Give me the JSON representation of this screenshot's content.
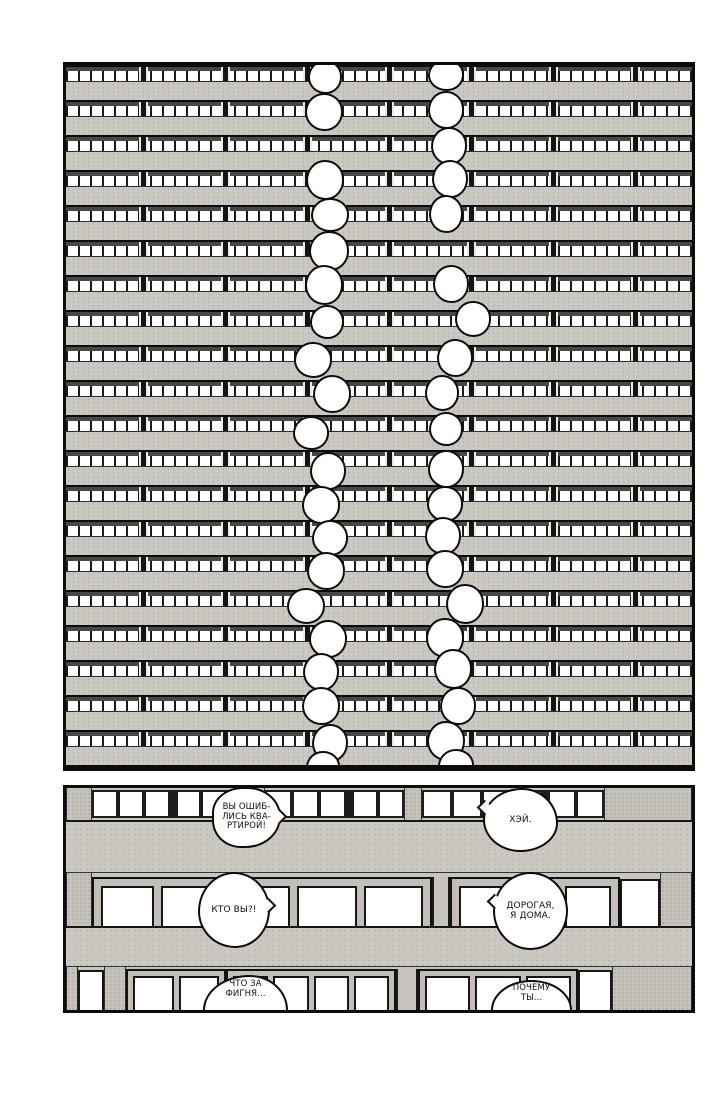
{
  "colors": {
    "ink": "#0c0c0c",
    "paper": "#ffffff",
    "concrete": "#cbc8c1"
  },
  "top_panel": {
    "floors": 20,
    "distant_bubbles": [
      {
        "x": 259,
        "y": 12,
        "w": 30,
        "h": 30
      },
      {
        "x": 380,
        "y": 10,
        "w": 32,
        "h": 28
      },
      {
        "x": 258,
        "y": 47,
        "w": 34,
        "h": 34
      },
      {
        "x": 380,
        "y": 45,
        "w": 32,
        "h": 34
      },
      {
        "x": 383,
        "y": 81,
        "w": 32,
        "h": 34
      },
      {
        "x": 259,
        "y": 115,
        "w": 34,
        "h": 36
      },
      {
        "x": 384,
        "y": 114,
        "w": 32,
        "h": 34
      },
      {
        "x": 264,
        "y": 150,
        "w": 34,
        "h": 30
      },
      {
        "x": 380,
        "y": 149,
        "w": 30,
        "h": 34
      },
      {
        "x": 263,
        "y": 186,
        "w": 36,
        "h": 36
      },
      {
        "x": 258,
        "y": 220,
        "w": 34,
        "h": 36
      },
      {
        "x": 385,
        "y": 219,
        "w": 32,
        "h": 34
      },
      {
        "x": 261,
        "y": 257,
        "w": 30,
        "h": 30
      },
      {
        "x": 407,
        "y": 254,
        "w": 32,
        "h": 32
      },
      {
        "x": 247,
        "y": 295,
        "w": 34,
        "h": 32
      },
      {
        "x": 389,
        "y": 293,
        "w": 32,
        "h": 34
      },
      {
        "x": 266,
        "y": 329,
        "w": 34,
        "h": 34
      },
      {
        "x": 376,
        "y": 328,
        "w": 30,
        "h": 32
      },
      {
        "x": 245,
        "y": 368,
        "w": 32,
        "h": 30
      },
      {
        "x": 380,
        "y": 364,
        "w": 30,
        "h": 30
      },
      {
        "x": 262,
        "y": 406,
        "w": 32,
        "h": 34
      },
      {
        "x": 380,
        "y": 404,
        "w": 32,
        "h": 34
      },
      {
        "x": 255,
        "y": 440,
        "w": 34,
        "h": 34
      },
      {
        "x": 379,
        "y": 439,
        "w": 32,
        "h": 32
      },
      {
        "x": 264,
        "y": 473,
        "w": 32,
        "h": 32
      },
      {
        "x": 377,
        "y": 471,
        "w": 32,
        "h": 34
      },
      {
        "x": 260,
        "y": 506,
        "w": 34,
        "h": 34
      },
      {
        "x": 379,
        "y": 504,
        "w": 34,
        "h": 34
      },
      {
        "x": 240,
        "y": 541,
        "w": 34,
        "h": 32
      },
      {
        "x": 399,
        "y": 539,
        "w": 34,
        "h": 36
      },
      {
        "x": 262,
        "y": 574,
        "w": 34,
        "h": 34
      },
      {
        "x": 379,
        "y": 573,
        "w": 34,
        "h": 36
      },
      {
        "x": 255,
        "y": 607,
        "w": 32,
        "h": 34
      },
      {
        "x": 387,
        "y": 604,
        "w": 34,
        "h": 36
      },
      {
        "x": 255,
        "y": 641,
        "w": 34,
        "h": 34
      },
      {
        "x": 392,
        "y": 641,
        "w": 32,
        "h": 34
      },
      {
        "x": 264,
        "y": 678,
        "w": 32,
        "h": 34
      },
      {
        "x": 380,
        "y": 676,
        "w": 34,
        "h": 36
      },
      {
        "x": 257,
        "y": 702,
        "w": 30,
        "h": 28
      },
      {
        "x": 390,
        "y": 701,
        "w": 32,
        "h": 30
      }
    ]
  },
  "bottom_panel": {
    "bubbles": [
      {
        "id": "wrong-apartment",
        "lines": [
          "ВЫ ОШИБ-",
          "ЛИСЬ КВА-",
          "РТИРОЙ!"
        ]
      },
      {
        "id": "hey",
        "lines": [
          "ХЭЙ."
        ]
      },
      {
        "id": "who-are-you",
        "lines": [
          "КТО ВЫ?!"
        ]
      },
      {
        "id": "darling-im-home",
        "lines": [
          "ДОРОГАЯ,",
          "Я ДОМА."
        ]
      },
      {
        "id": "what-the-heck",
        "lines": [
          "ЧТО ЗА",
          "ФИГНЯ..."
        ]
      },
      {
        "id": "why-you",
        "lines": [
          "ПОЧЕМУ",
          "ТЫ..."
        ]
      }
    ]
  }
}
